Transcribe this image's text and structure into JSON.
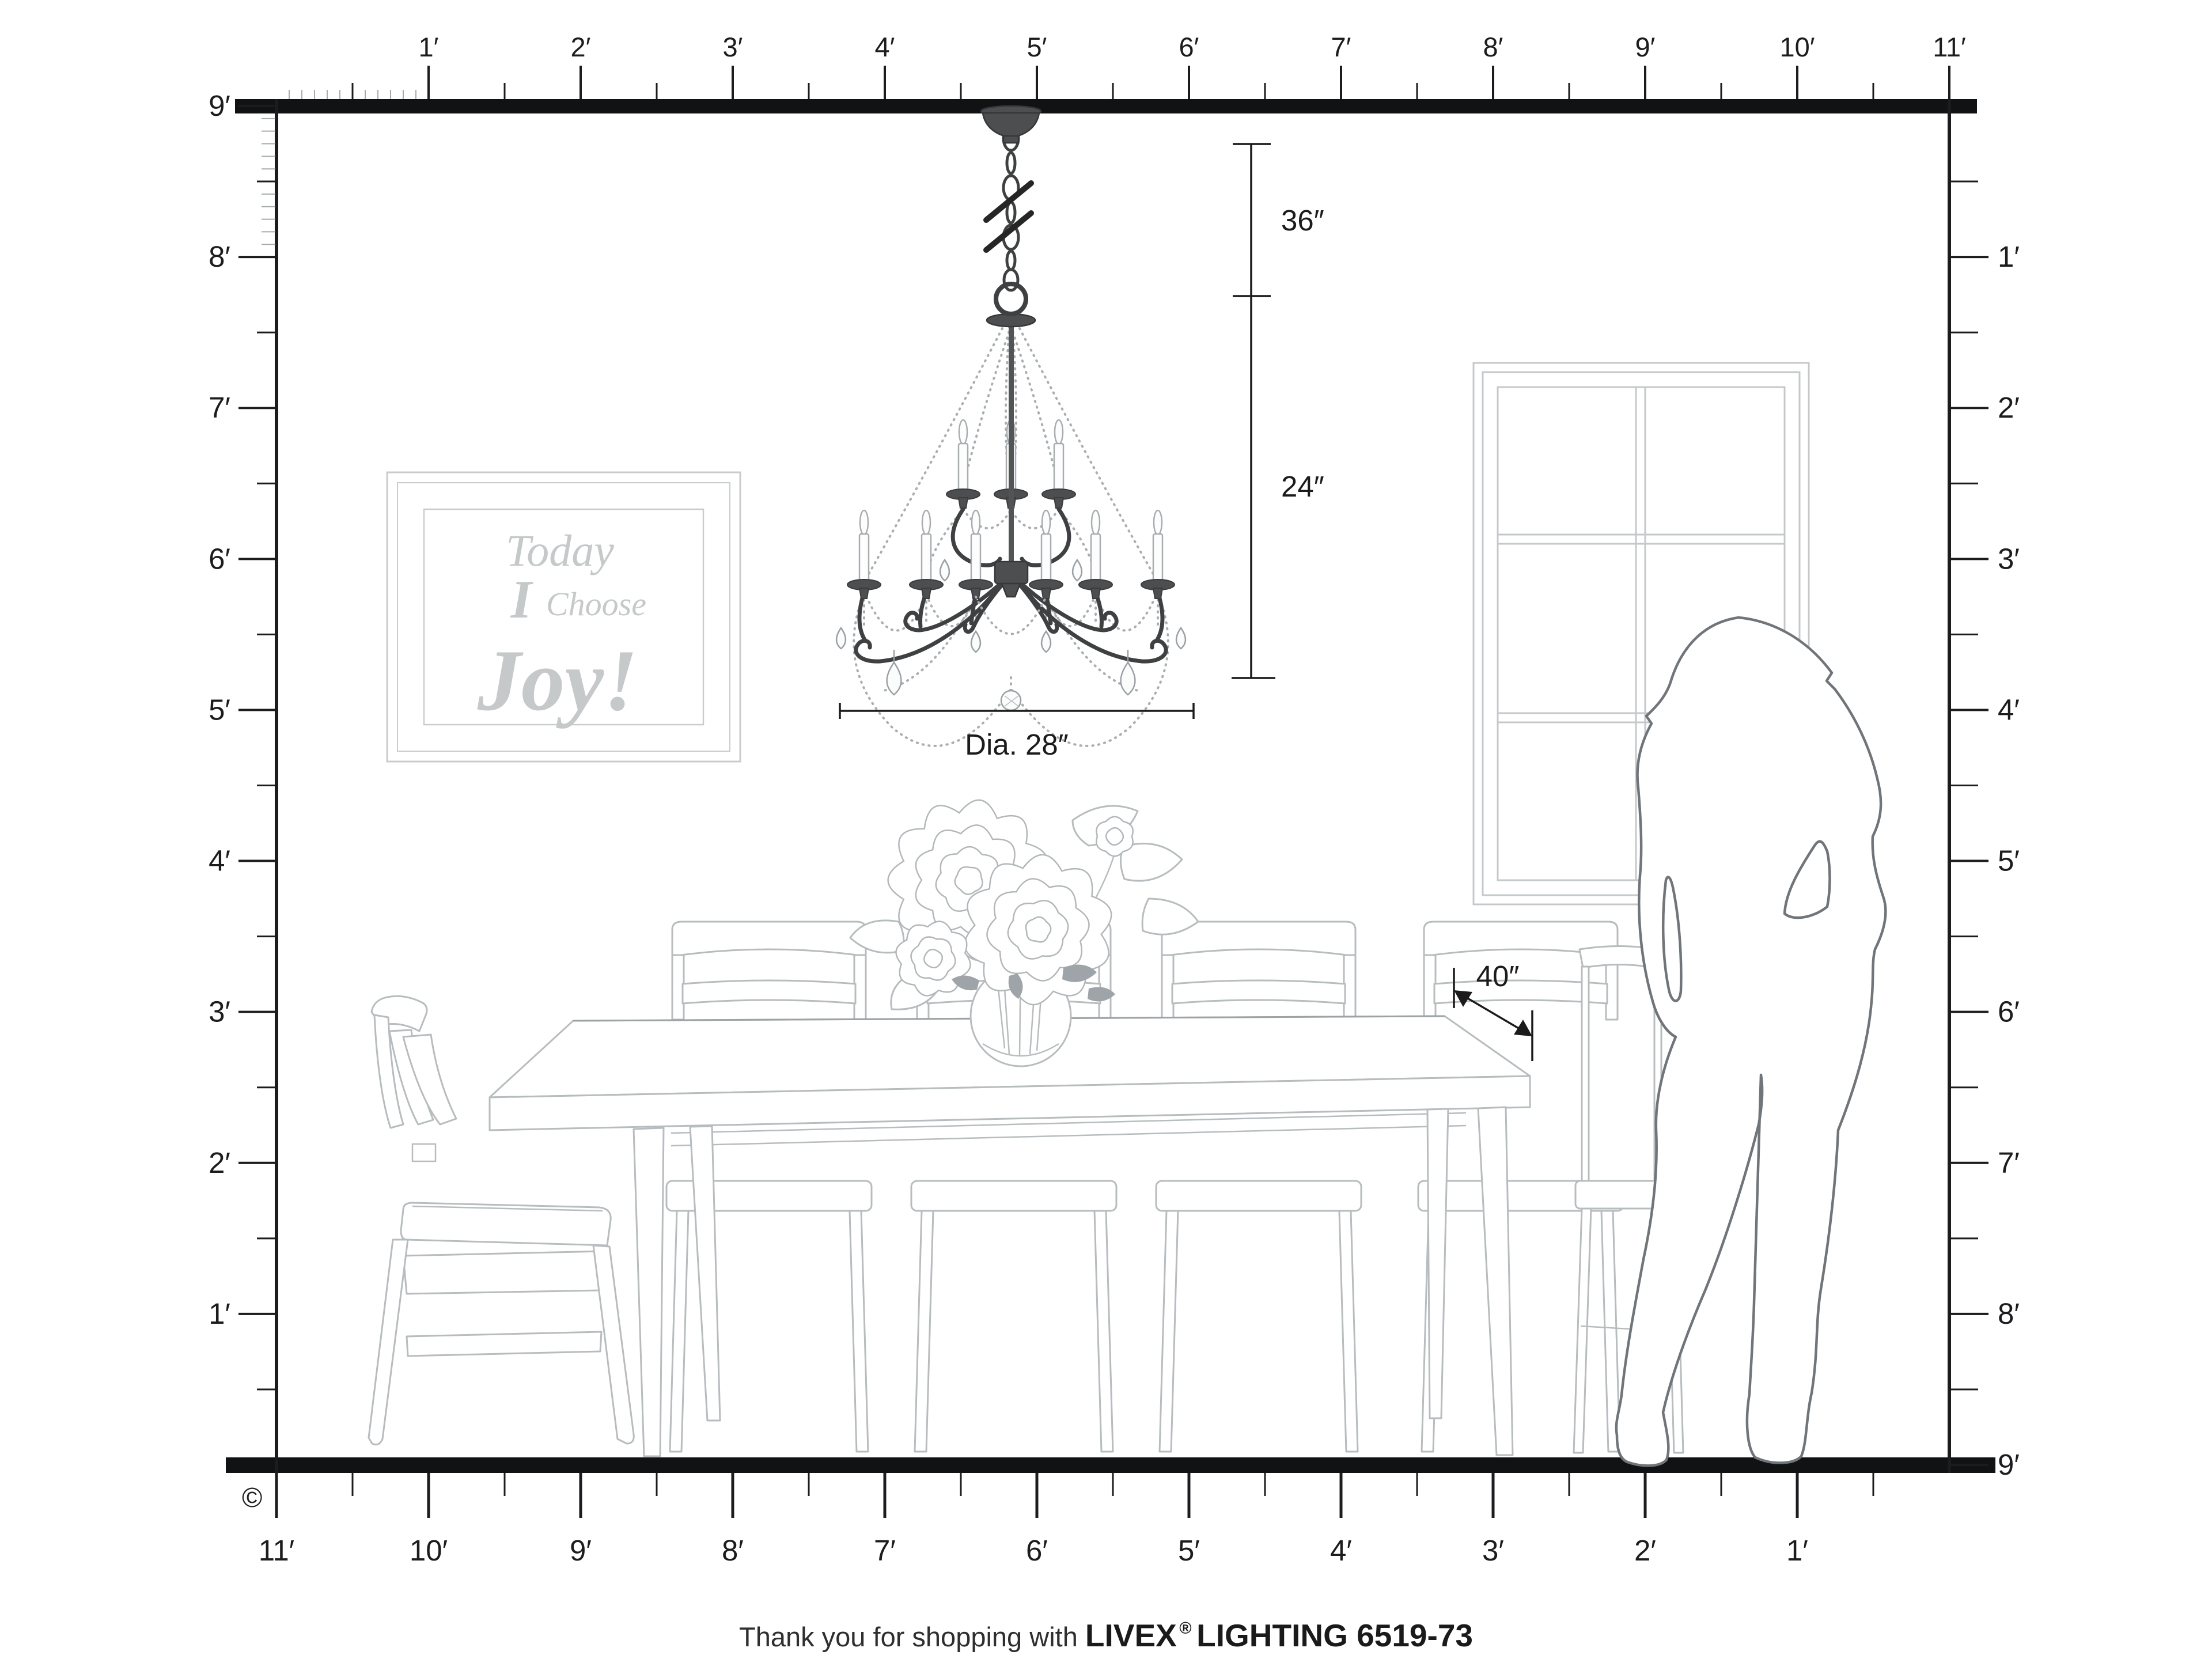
{
  "page": {
    "copyright": "©"
  },
  "rulers": {
    "top": [
      "1′",
      "2′",
      "3′",
      "4′",
      "5′",
      "6′",
      "7′",
      "8′",
      "9′",
      "10′",
      "11′"
    ],
    "bottom": [
      "11′",
      "10′",
      "9′",
      "8′",
      "7′",
      "6′",
      "5′",
      "4′",
      "3′",
      "2′",
      "1′"
    ],
    "left": [
      "9′",
      "8′",
      "7′",
      "6′",
      "5′",
      "4′",
      "3′",
      "2′",
      "1′"
    ],
    "right": [
      "1′",
      "2′",
      "3′",
      "4′",
      "5′",
      "6′",
      "7′",
      "8′",
      "9′"
    ]
  },
  "dimensions": {
    "hang_length": "36″",
    "fixture_height": "24″",
    "diameter": "Dia. 28″",
    "table_clearance": "40″"
  },
  "wall_art": {
    "line1": "Today",
    "line2_a": "I",
    "line2_b": "Choose",
    "line3": "Joy!"
  },
  "footer": {
    "prefix": "Thank you for shopping with ",
    "brand": "LIVEX",
    "registered": "®",
    "product": "LIGHTING 6519-73"
  },
  "colors": {
    "ruler_ink": "#1c1c1e",
    "furniture_line": "#b7bcbe",
    "window_line": "#c5c8ca",
    "art_text": "#c6c9ca",
    "silhouette_line": "#70757a",
    "chandelier_metal": "#3e4042",
    "bead_chain": "#a9aeb1",
    "dimension_ink": "#1b1b1b",
    "background": "#ffffff"
  }
}
